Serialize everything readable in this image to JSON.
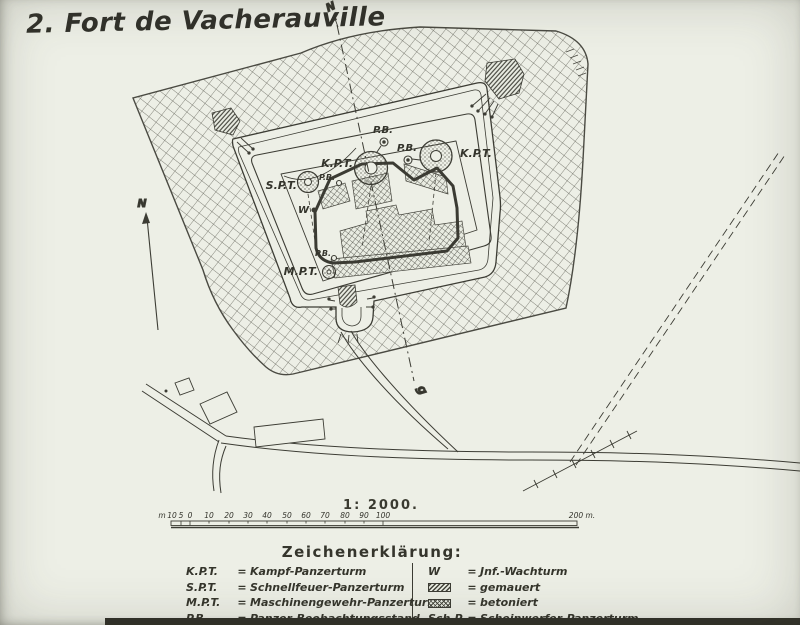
{
  "title": "2. Fort de Vacherauville",
  "colors": {
    "paper": "#edefe6",
    "ink": "#3c3c34",
    "hatch": "#5c5c52"
  },
  "north": {
    "arrow_label": "N",
    "axis_top": "N",
    "axis_bottom": "g"
  },
  "map_labels": {
    "pb_top": "P.B.",
    "kpt_center": "K.P.T.",
    "pb_right": "P.B.",
    "kpt_right": "K.P.T.",
    "spt": "S.P.T.",
    "pb_left": "P.B.",
    "w": "W",
    "pb_bottom": "P.B.",
    "mpt": "M.P.T."
  },
  "scale": {
    "ratio": "1: 2000.",
    "unit_prefix": "m",
    "left_ticks": [
      "10",
      "5",
      "0"
    ],
    "ticks": [
      "10",
      "20",
      "30",
      "40",
      "50",
      "60",
      "70",
      "80",
      "90",
      "100"
    ],
    "end_label": "200 m."
  },
  "legend": {
    "heading": "Zeichenerklärung:",
    "eq": "=",
    "left": [
      {
        "abbr": "K.P.T.",
        "term": "Kampf-Panzerturm"
      },
      {
        "abbr": "S.P.T.",
        "term": "Schnellfeuer-Panzerturm"
      },
      {
        "abbr": "M.P.T.",
        "term": "Maschinengewehr-Panzerturm"
      },
      {
        "abbr": "P.B.",
        "term": "Panzer-Beobachtungsstand"
      }
    ],
    "right": [
      {
        "abbr": "W",
        "term": "Jnf.-Wachturm",
        "swatch": "none"
      },
      {
        "abbr": "",
        "term": "gemauert",
        "swatch": "hatch-diagonal"
      },
      {
        "abbr": "",
        "term": "betoniert",
        "swatch": "hatch-cross"
      },
      {
        "abbr": "Sch.P.",
        "term": "Scheinwerfer-Panzerturm",
        "swatch": "none"
      }
    ]
  }
}
